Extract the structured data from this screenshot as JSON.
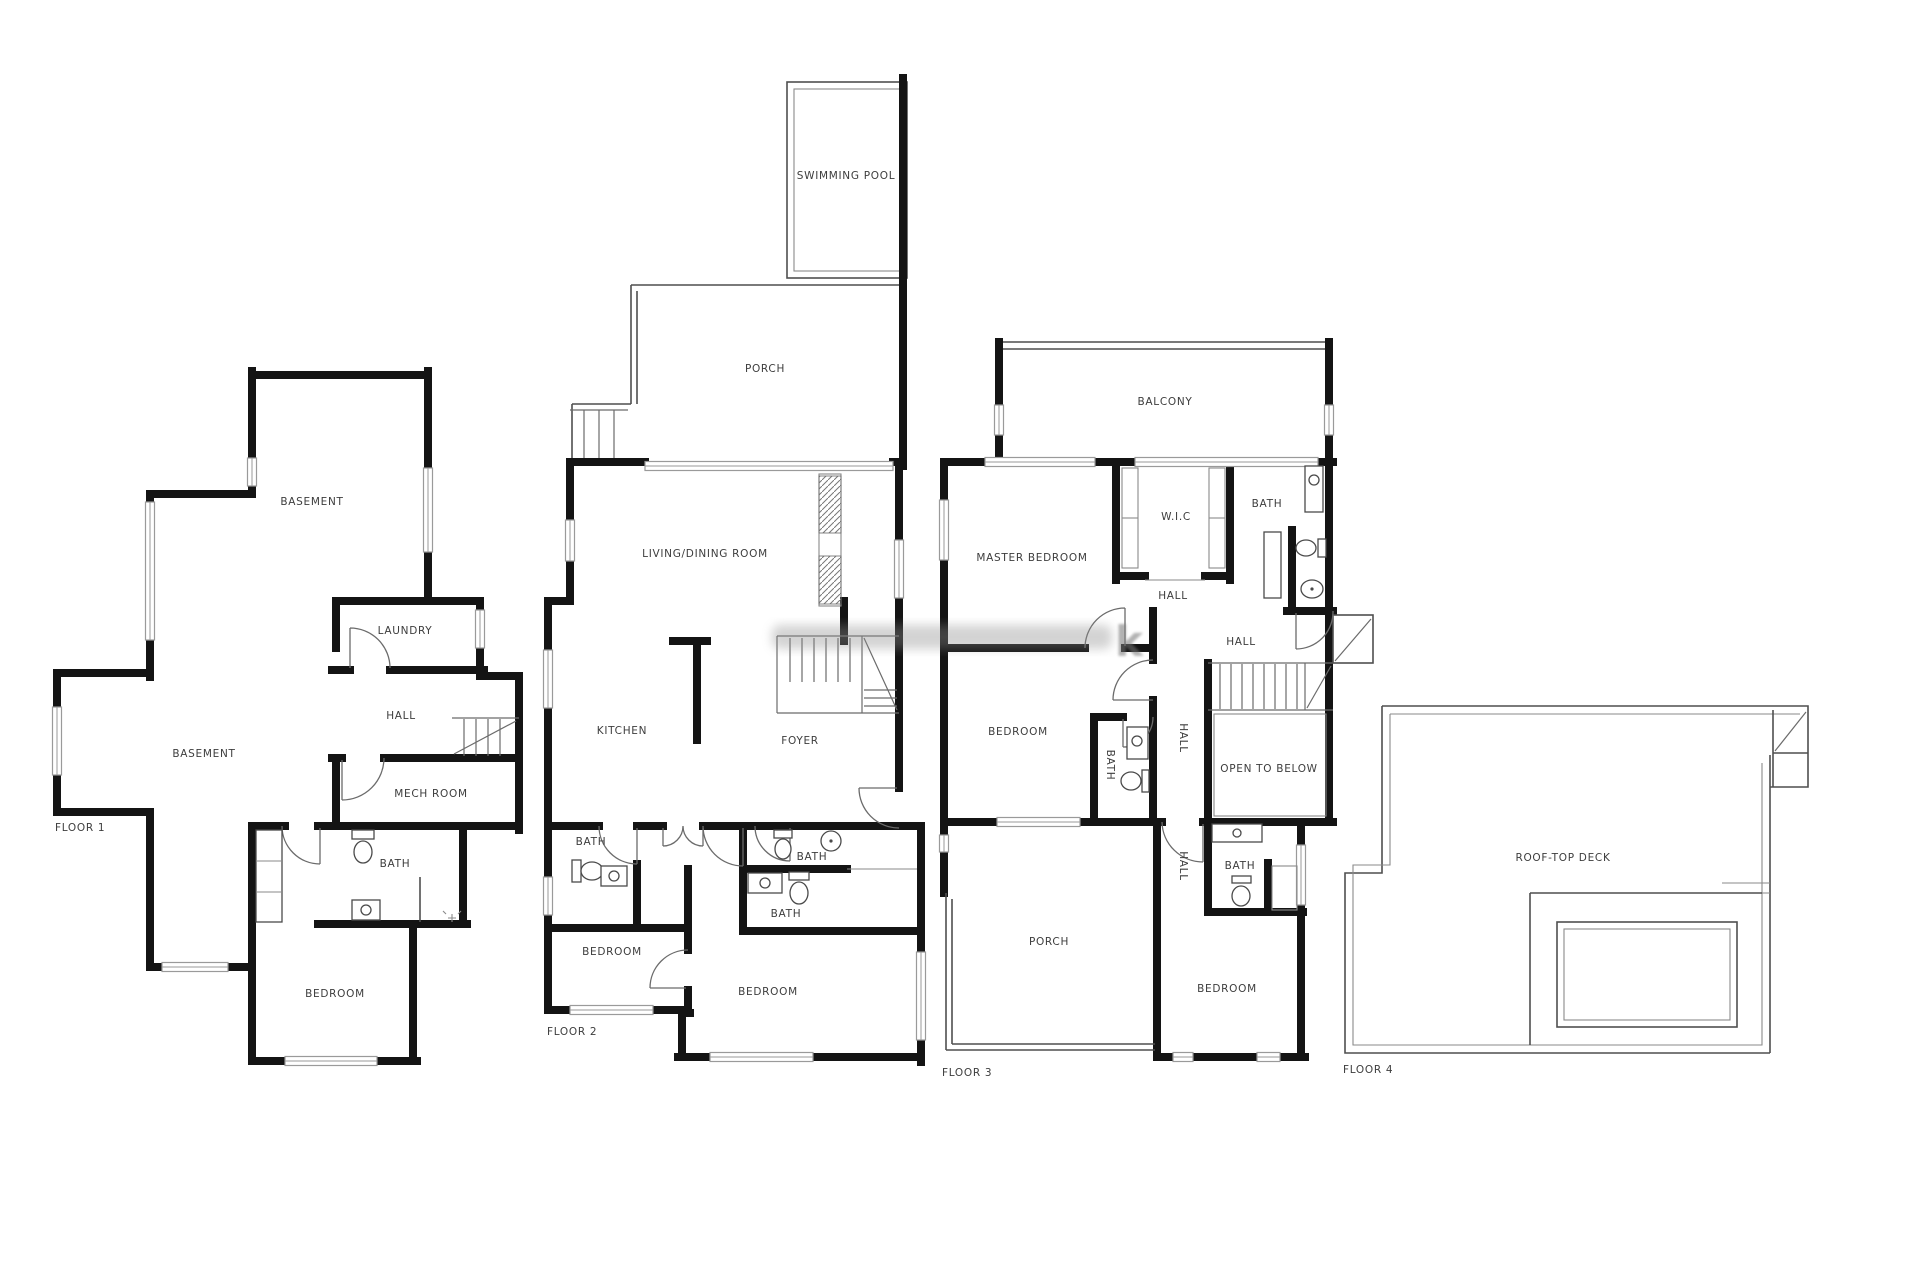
{
  "canvas": {
    "width": 1920,
    "height": 1280,
    "background": "#ffffff"
  },
  "palette": {
    "wall": "#141414",
    "thin_line": "#4f4f4f",
    "window_line": "#9a9a9a",
    "label": "#3d3d3d",
    "watermark": "#757575"
  },
  "floors": [
    {
      "id": "floor-1",
      "label": "FLOOR 1",
      "rooms": [
        {
          "key": "basement-upper",
          "label": "BASEMENT"
        },
        {
          "key": "basement-lower",
          "label": "BASEMENT"
        },
        {
          "key": "laundry",
          "label": "LAUNDRY"
        },
        {
          "key": "hall",
          "label": "HALL"
        },
        {
          "key": "mech-room",
          "label": "MECH ROOM"
        },
        {
          "key": "bath",
          "label": "BATH"
        },
        {
          "key": "bedroom",
          "label": "BEDROOM"
        }
      ]
    },
    {
      "id": "floor-2",
      "label": "FLOOR 2",
      "rooms": [
        {
          "key": "swimming-pool",
          "label": "SWIMMING POOL"
        },
        {
          "key": "porch",
          "label": "PORCH"
        },
        {
          "key": "living-dining-room",
          "label": "LIVING/DINING ROOM"
        },
        {
          "key": "kitchen",
          "label": "KITCHEN"
        },
        {
          "key": "foyer",
          "label": "FOYER"
        },
        {
          "key": "bath-left",
          "label": "BATH"
        },
        {
          "key": "bath-upper-right",
          "label": "BATH"
        },
        {
          "key": "bath-lower-right",
          "label": "BATH"
        },
        {
          "key": "bedroom-left",
          "label": "BEDROOM"
        },
        {
          "key": "bedroom-right",
          "label": "BEDROOM"
        }
      ]
    },
    {
      "id": "floor-3",
      "label": "FLOOR 3",
      "rooms": [
        {
          "key": "balcony",
          "label": "BALCONY"
        },
        {
          "key": "master-bedroom",
          "label": "MASTER BEDROOM"
        },
        {
          "key": "wic",
          "label": "W.I.C"
        },
        {
          "key": "bath-top",
          "label": "BATH"
        },
        {
          "key": "hall-upper",
          "label": "HALL"
        },
        {
          "key": "hall-landing",
          "label": "HALL"
        },
        {
          "key": "bedroom-middle",
          "label": "BEDROOM"
        },
        {
          "key": "bath-middle",
          "label": "BATH"
        },
        {
          "key": "hall-corridor",
          "label": "HALL"
        },
        {
          "key": "open-to-below",
          "label": "OPEN TO BELOW"
        },
        {
          "key": "hall-lower",
          "label": "HALL"
        },
        {
          "key": "bath-lower",
          "label": "BATH"
        },
        {
          "key": "porch",
          "label": "PORCH"
        },
        {
          "key": "bedroom-lower",
          "label": "BEDROOM"
        }
      ]
    },
    {
      "id": "floor-4",
      "label": "FLOOR 4",
      "rooms": [
        {
          "key": "roof-top-deck",
          "label": "ROOF-TOP DECK"
        }
      ]
    }
  ],
  "watermark": {
    "glyph": "k"
  }
}
